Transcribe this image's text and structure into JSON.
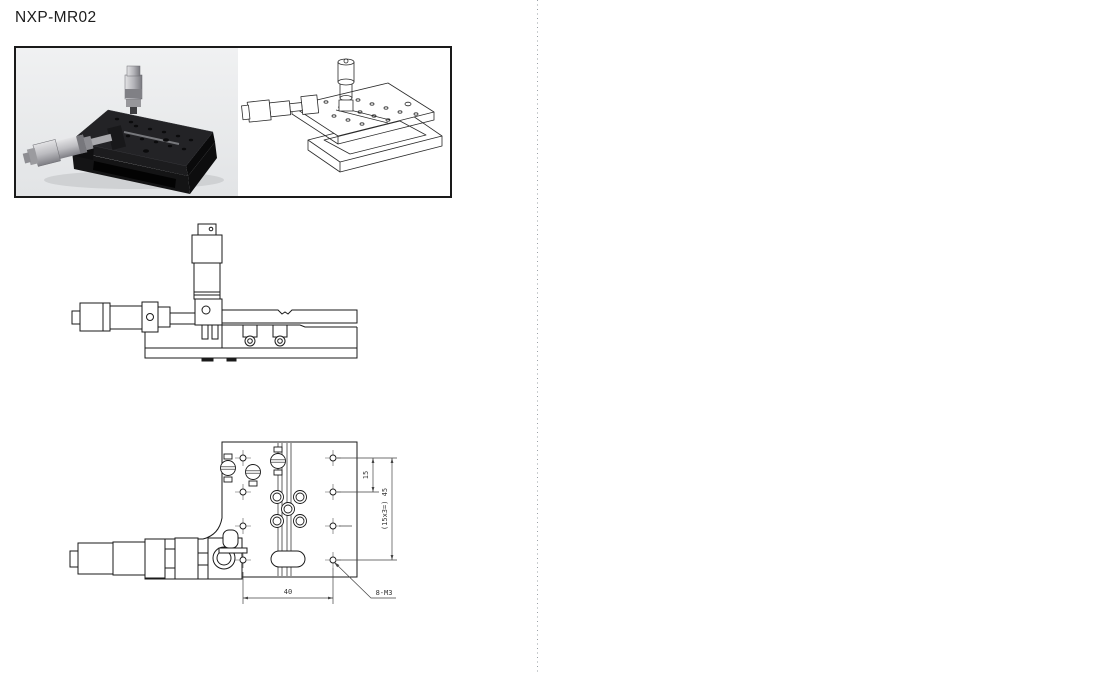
{
  "product": {
    "title": "NXP-MR02"
  },
  "drawing": {
    "dim_15": "15",
    "dim_total": "(15x3=) 45",
    "dim_40": "40",
    "hole_spec": "8-M3"
  },
  "colors": {
    "line": "#1a1a1a",
    "dimension_line": "#444444",
    "photo_background": "#e9ebec",
    "frame_border": "#1a1a1a",
    "separator_dot": "#9aa0a6"
  }
}
